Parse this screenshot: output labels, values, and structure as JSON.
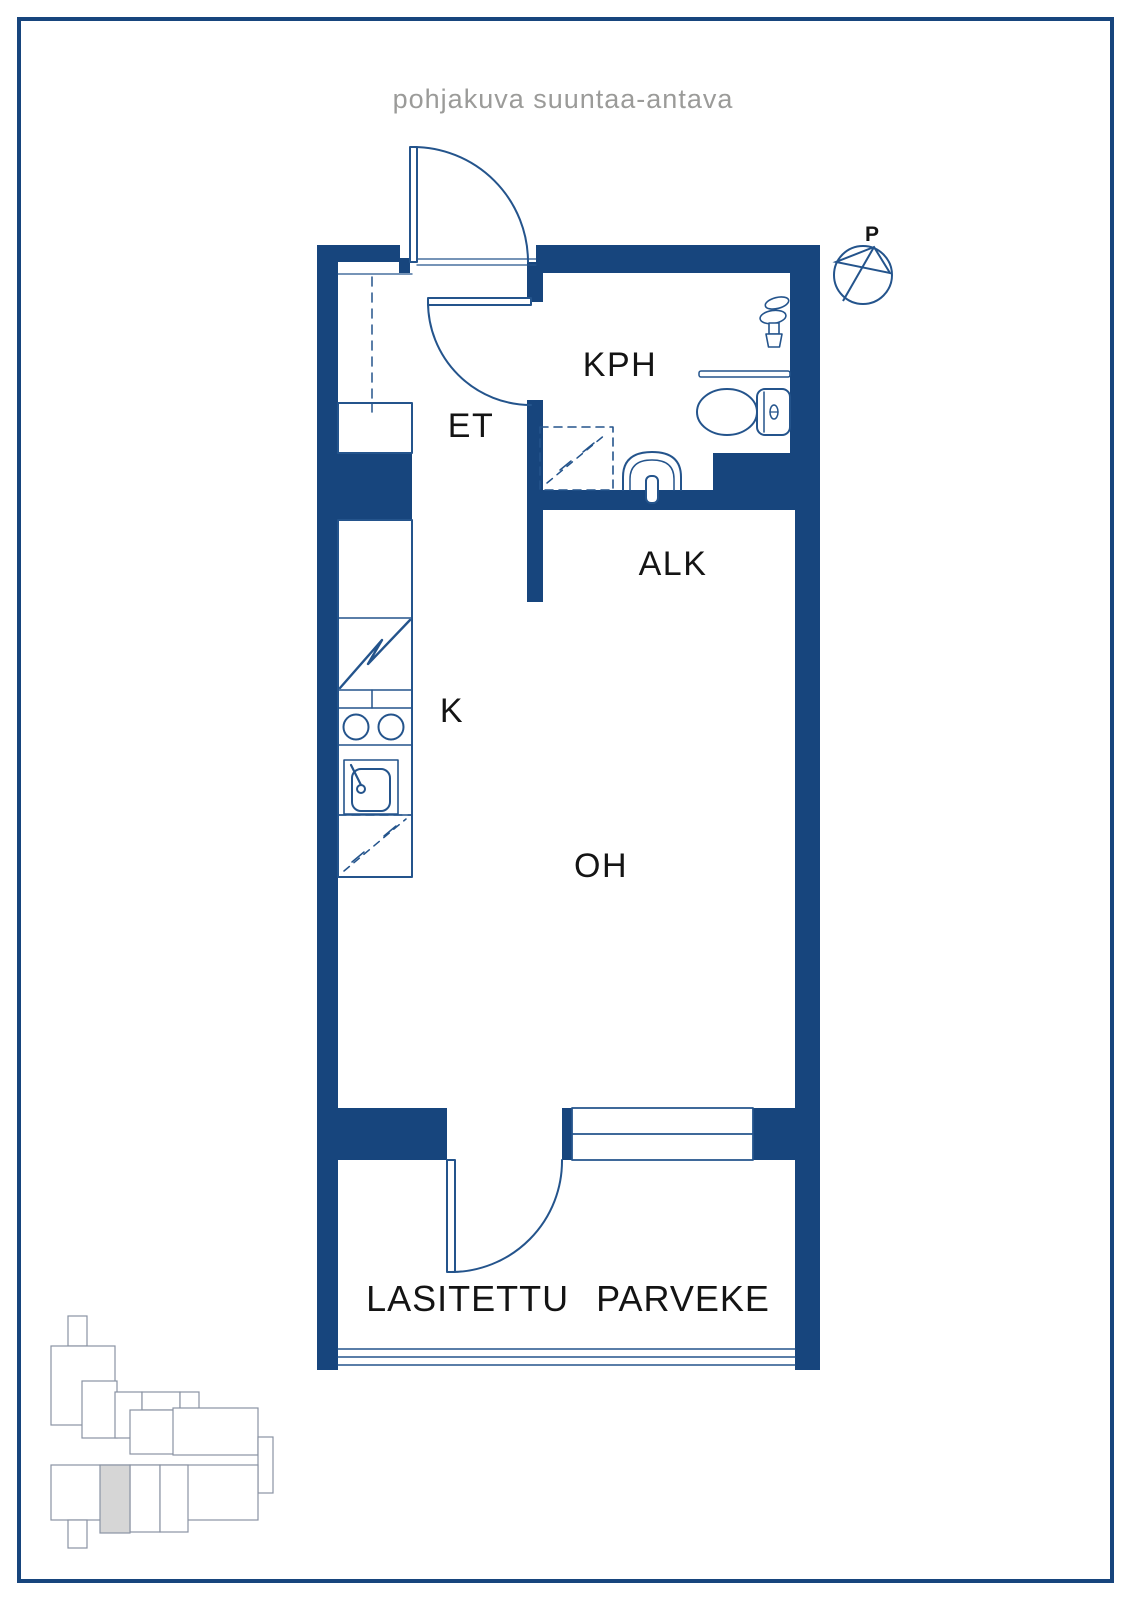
{
  "page": {
    "title": "pohjakuva suuntaa-antava",
    "colors": {
      "border": "#17457d",
      "background": "#ffffff",
      "title_text": "#9b9b99"
    }
  },
  "floorplan": {
    "colors": {
      "wall": "#17457d",
      "line": "#24548c",
      "label_text": "#141414"
    },
    "labels": {
      "bathroom": "KPH",
      "entrance": "ET",
      "alcove": "ALK",
      "kitchen": "K",
      "living_room": "OH",
      "balcony": "LASITETTU PARVEKE"
    },
    "compass": {
      "north": "P"
    },
    "fixtures": [
      "entry-door",
      "bathroom-door",
      "balcony-door",
      "window",
      "wardrobe",
      "fridge-cabinet",
      "stove",
      "cooktop-burners",
      "kitchen-sink",
      "dishwasher-reservation",
      "washing-machine-reservation",
      "washbasin",
      "toilet",
      "shower-mixer",
      "towel-rail",
      "balcony-glazing"
    ]
  },
  "site_plan": {
    "colors": {
      "outline": "#8a93a3",
      "highlight": "#d6d6d6"
    }
  }
}
